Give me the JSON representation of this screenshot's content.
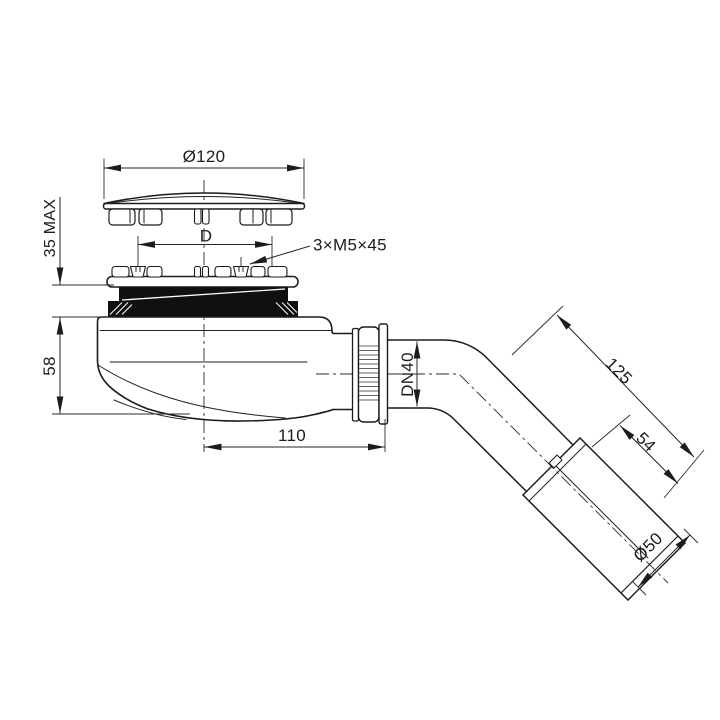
{
  "drawing": {
    "background": "#ffffff",
    "line_color": "#1b1b1b",
    "gasket_color": "#101010",
    "dimensions": {
      "cover_diameter": "Ø120",
      "installed_height_max": "35 MAX",
      "screw_circle": "D",
      "screw_spec": "3×M5×45",
      "trap_height": "58",
      "center_to_outlet": "110",
      "outlet_nominal_diameter": "DN40",
      "outlet_length": "125",
      "socket_length": "54",
      "socket_outer_diameter": "Ø50"
    }
  }
}
